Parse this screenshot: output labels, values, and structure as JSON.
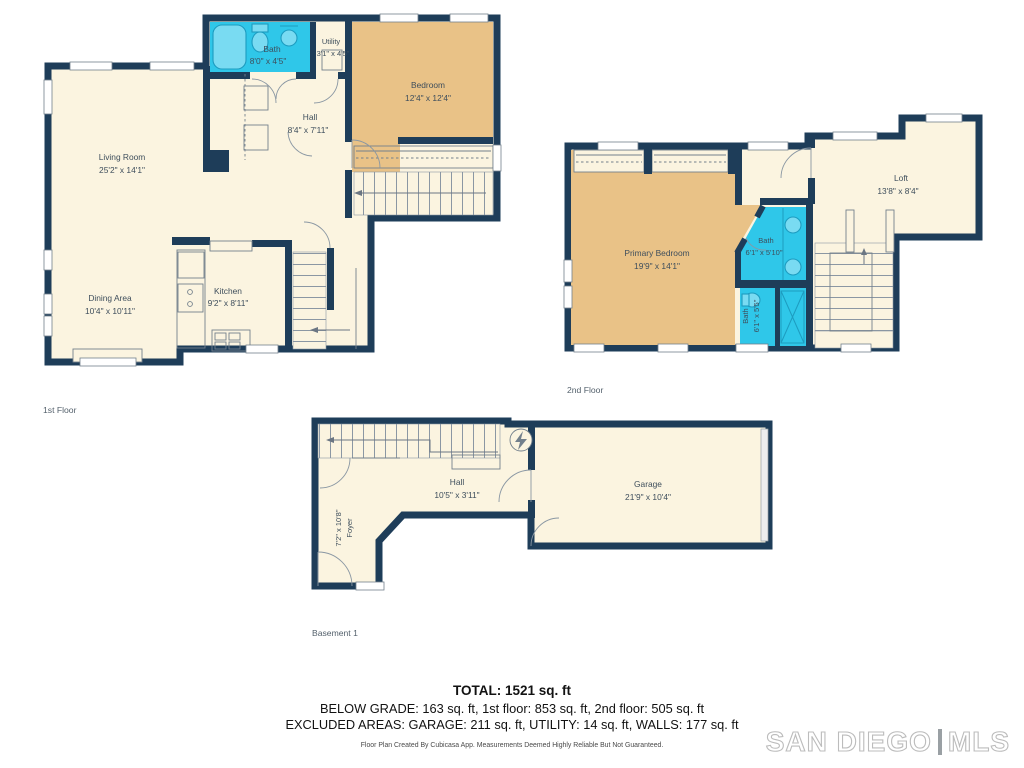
{
  "colors": {
    "wall": "#1e3d59",
    "floor": "#fbf4e0",
    "bedroom": "#e9c287",
    "bath": "#2fc7e9",
    "lines": "#73808c"
  },
  "floors": [
    {
      "name": "1st Floor",
      "rooms": [
        {
          "label": "Living Room",
          "dims": "25'2\" x 14'1\""
        },
        {
          "label": "Dining Area",
          "dims": "10'4\" x 10'11\""
        },
        {
          "label": "Kitchen",
          "dims": "9'2\" x 8'11\""
        },
        {
          "label": "Hall",
          "dims": "8'4\" x 7'11\""
        },
        {
          "label": "Bath",
          "dims": "8'0\" x 4'5\""
        },
        {
          "label": "Utility",
          "dims": "3'1\" x 4'5\""
        },
        {
          "label": "Bedroom",
          "dims": "12'4\" x 12'4\""
        }
      ]
    },
    {
      "name": "2nd Floor",
      "rooms": [
        {
          "label": "Primary Bedroom",
          "dims": "19'9\" x 14'1\""
        },
        {
          "label": "Bath",
          "dims": "6'1\" x 5'10\""
        },
        {
          "label": "Bath",
          "dims": "6'1\" x 5'5\""
        },
        {
          "label": "Loft",
          "dims": "13'8\" x 8'4\""
        }
      ]
    },
    {
      "name": "Basement 1",
      "rooms": [
        {
          "label": "Foyer",
          "dims": "7'2\" x 10'8\""
        },
        {
          "label": "Hall",
          "dims": "10'5\" x 3'11\""
        },
        {
          "label": "Garage",
          "dims": "21'9\" x 10'4\""
        }
      ]
    }
  ],
  "summary": {
    "total": "TOTAL: 1521 sq. ft",
    "line2": "BELOW GRADE: 163 sq. ft, 1st floor: 853 sq. ft, 2nd floor: 505 sq. ft",
    "line3": "EXCLUDED AREAS: GARAGE: 211 sq. ft, UTILITY: 14 sq. ft, WALLS: 177 sq. ft",
    "disclaimer": "Floor Plan Created By Cubicasa App. Measurements Deemed Highly Reliable But Not Guaranteed."
  },
  "logo": {
    "left": "SAN DIEGO",
    "right": "MLS"
  }
}
